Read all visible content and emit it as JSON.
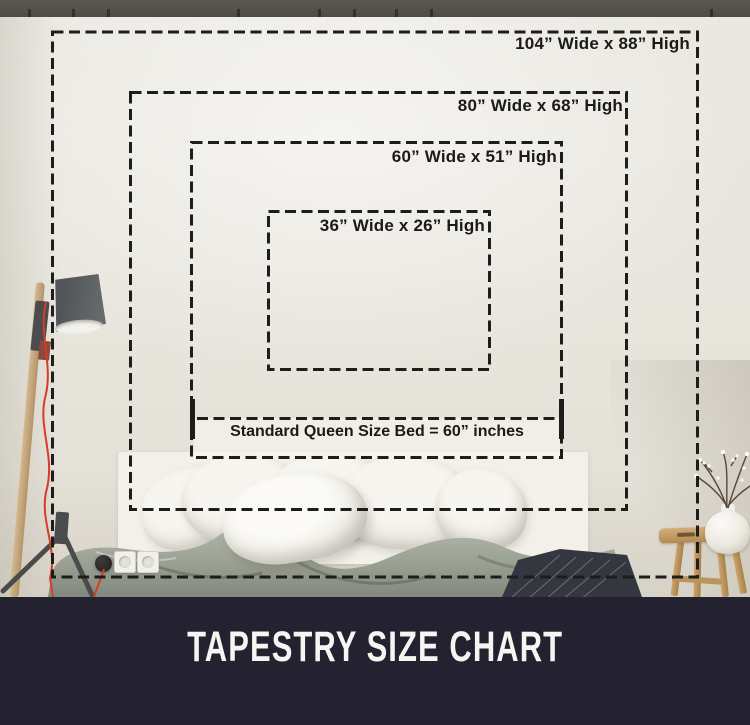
{
  "page": {
    "title": "TAPESTRY SIZE CHART"
  },
  "size_overlay": {
    "sizes": [
      {
        "width_in": 104,
        "height_in": 88,
        "label": "104” Wide x 88” High"
      },
      {
        "width_in": 80,
        "height_in": 68,
        "label": "80” Wide x 68” High"
      },
      {
        "width_in": 60,
        "height_in": 51,
        "label": "60” Wide x 51” High"
      },
      {
        "width_in": 36,
        "height_in": 26,
        "label": "36” Wide x 26” High"
      }
    ],
    "bed_reference": {
      "width_in": 60,
      "label": "Standard Queen Size Bed = 60” inches"
    }
  },
  "colors": {
    "band_bg": "#242230",
    "title_text": "#f6f5f2",
    "dash": "#1d1d1b",
    "label_text": "#1b1a17",
    "wall": "#e9e6df",
    "strip": "#55524d",
    "cable_red": "#d63c2a",
    "sage": "#a3a89b"
  }
}
